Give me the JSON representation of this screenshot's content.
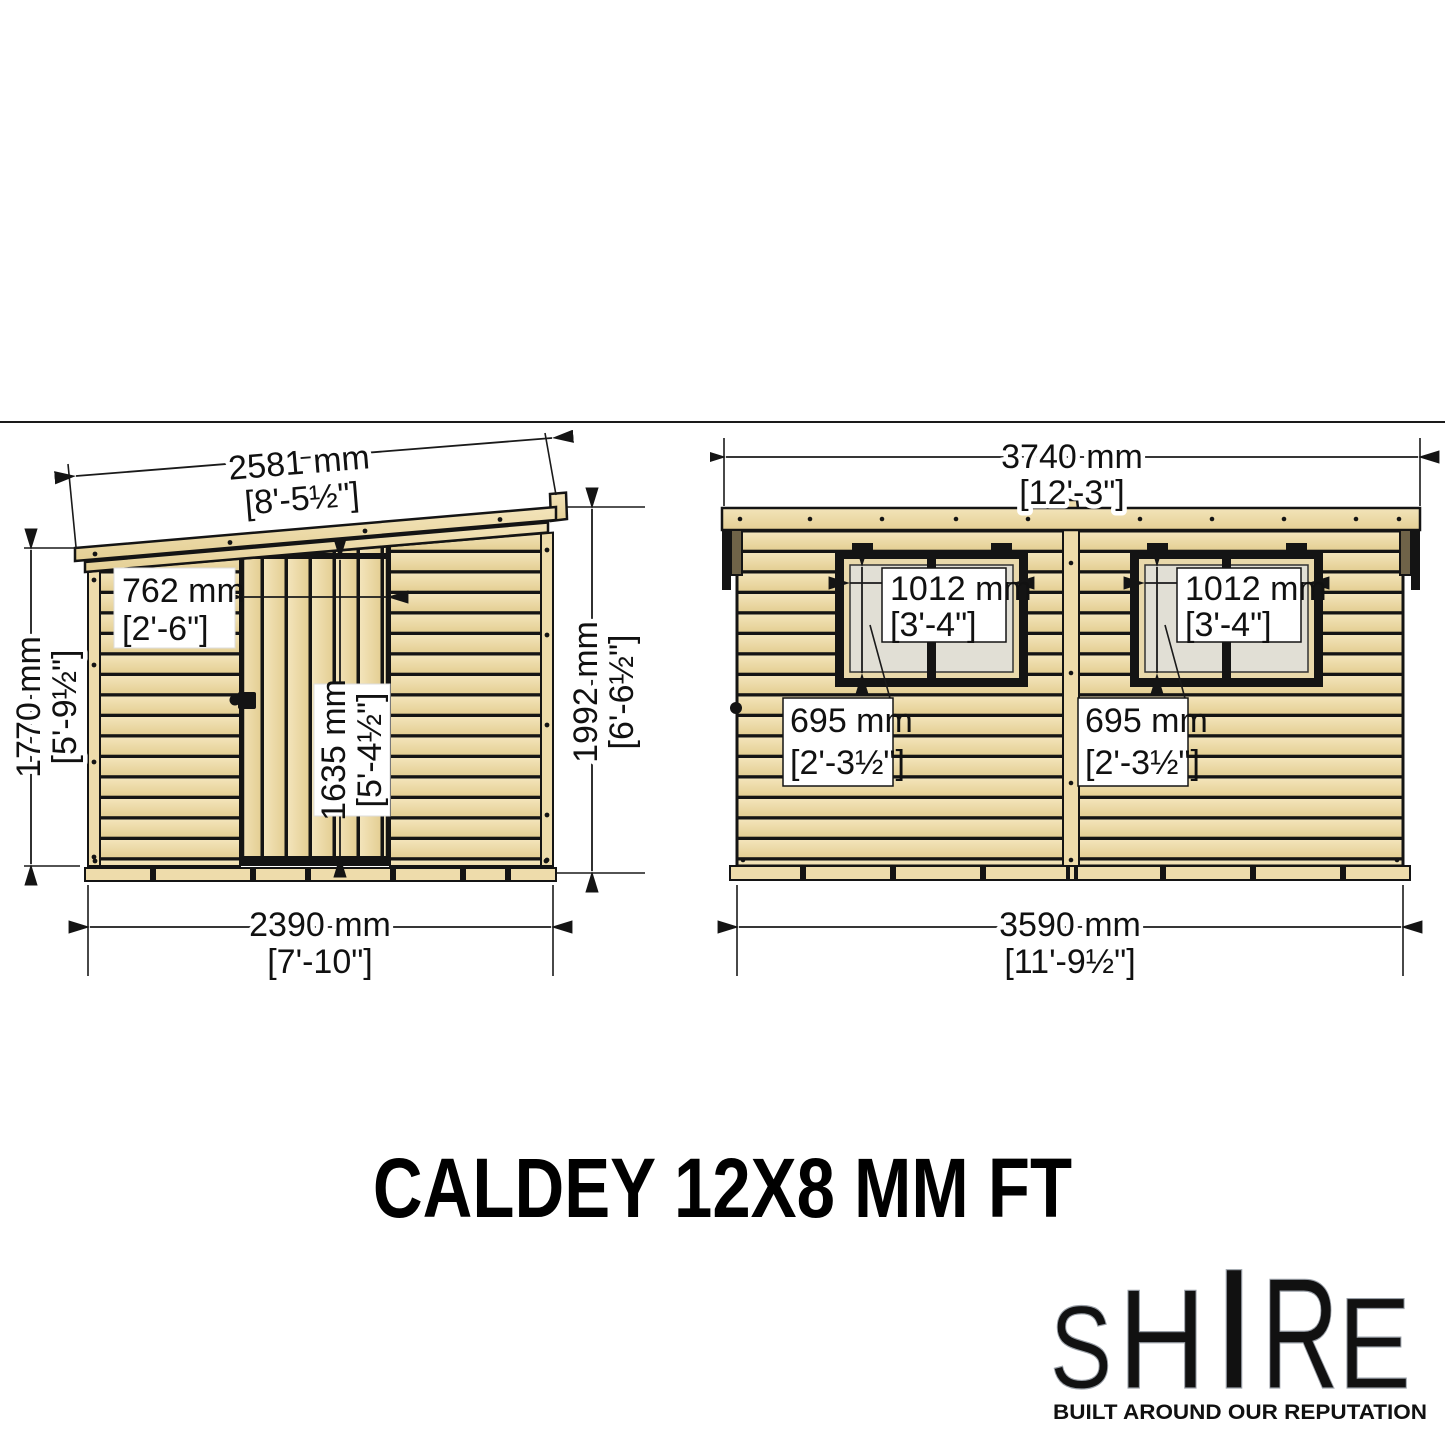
{
  "title": "CALDEY 12X8 MM FT",
  "front": {
    "roof_width": {
      "mm": "2581 mm",
      "imperial": "[8'-5½\"]"
    },
    "door_width": {
      "mm": "762 mm",
      "imperial": "[2'-6\"]"
    },
    "door_height": {
      "mm": "1635 mm",
      "imperial": "[5'-4½\"]"
    },
    "eaves_height": {
      "mm": "1770 mm",
      "imperial": "[5'-9½\"]"
    },
    "ridge_height": {
      "mm": "1992 mm",
      "imperial": "[6'-6½\"]"
    },
    "base_width": {
      "mm": "2390 mm",
      "imperial": "[7'-10\"]"
    }
  },
  "side": {
    "roof_length": {
      "mm": "3740 mm",
      "imperial": "[12'-3\"]"
    },
    "window_width": {
      "mm": "1012 mm",
      "imperial": "[3'-4\"]"
    },
    "window_height": {
      "mm": "695 mm",
      "imperial": "[2'-3½\"]"
    },
    "base_length": {
      "mm": "3590 mm",
      "imperial": "[11'-9½\"]"
    }
  },
  "logo": {
    "brand": "SHIRE",
    "letters": [
      "S",
      "H",
      "I",
      "R",
      "E"
    ],
    "tagline": "BUILT AROUND OUR REPUTATION"
  },
  "colors": {
    "wood": "#eedcab",
    "wood_light": "#f3e4ba",
    "wood_dark": "#e6d094",
    "glass": "#e1dfd5",
    "outline": "#141414",
    "bracket": "#6f6348",
    "logo_red": "#c0392b",
    "logo_blue": "#27408b"
  }
}
